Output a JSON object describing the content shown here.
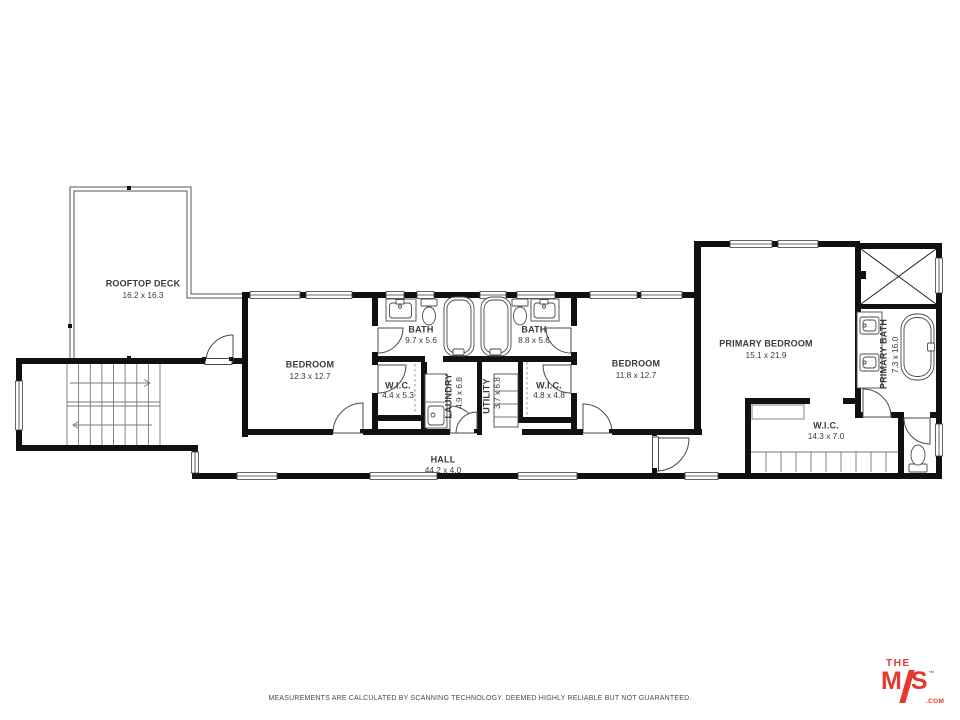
{
  "plan": {
    "rooms": {
      "deck": {
        "name": "ROOFTOP DECK",
        "dims": "16.2 x 16.3"
      },
      "bedroom1": {
        "name": "BEDROOM",
        "dims": "12.3 x 12.7"
      },
      "bath1": {
        "name": "BATH",
        "dims": "9.7 x 5.6"
      },
      "bath2": {
        "name": "BATH",
        "dims": "8.8 x 5.6"
      },
      "wic1": {
        "name": "W.I.C.",
        "dims": "4.4 x 5.3"
      },
      "laundry": {
        "name": "LAUNDRY",
        "dims": "4.9 x 6.8"
      },
      "utility": {
        "name": "UTILITY",
        "dims": "3.7 x 6.8"
      },
      "wic2": {
        "name": "W.I.C.",
        "dims": "4.8 x 4.8"
      },
      "bedroom2": {
        "name": "BEDROOM",
        "dims": "11.8 x 12.7"
      },
      "primary_bedroom": {
        "name": "PRIMARY BEDROOM",
        "dims": "15.1 x 21.9"
      },
      "primary_bath": {
        "name": "PRIMARY BATH",
        "dims": "7.3 x 16.0"
      },
      "primary_wic": {
        "name": "W.I.C.",
        "dims": "14.3 x 7.0"
      },
      "hall": {
        "name": "HALL",
        "dims": "44.2 x 4.0"
      }
    }
  },
  "footer": {
    "disclaimer": "MEASUREMENTS ARE CALCULATED BY SCANNING TECHNOLOGY. DEEMED HIGHLY RELIABLE BUT NOT GUARANTEED."
  },
  "logo": {
    "the": "THE",
    "m": "M",
    "s": "S",
    "tm": "™",
    "com": ".COM"
  },
  "colors": {
    "wall": "#111111",
    "logo_red": "#e5372d"
  }
}
